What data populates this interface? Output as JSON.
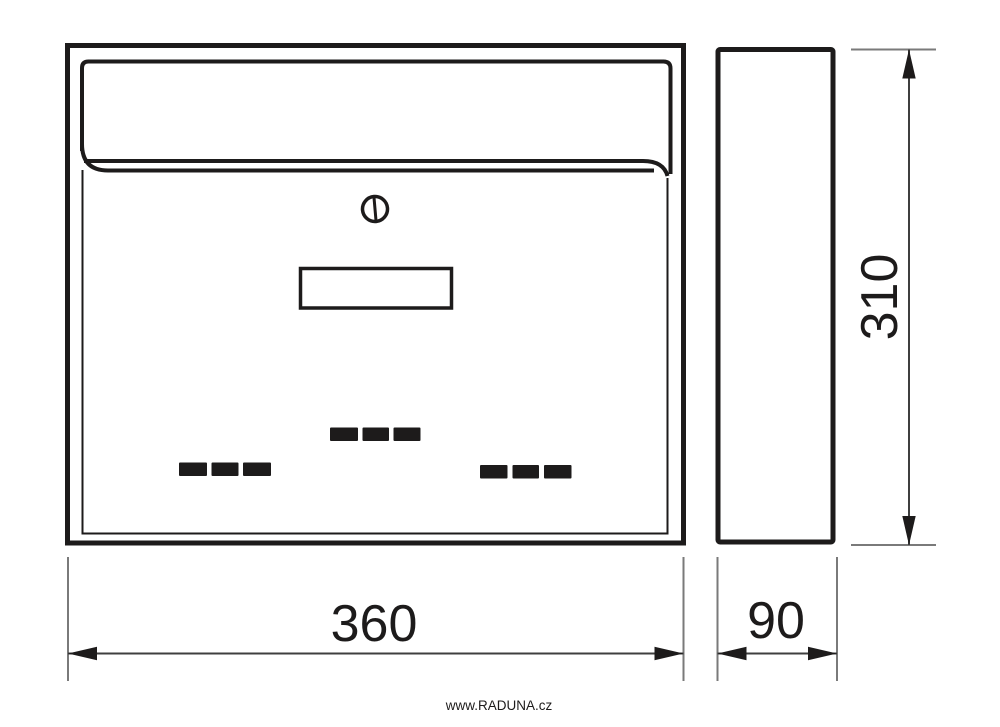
{
  "diagram": {
    "subject": "mailbox-dimension-drawing",
    "views": {
      "front": "front-view",
      "side": "side-view"
    },
    "dimensions": {
      "width": "360",
      "depth": "90",
      "height": "310"
    },
    "footer": {
      "website": "www.RADUNA.cz"
    },
    "icons": {
      "lock": "cylinder-lock-icon",
      "nameplate": "nameplate-window",
      "dashes": "redacted-text-dashes"
    },
    "colors": {
      "line": "#1d1b1b",
      "extension_line": "#7a7a7a",
      "dimension_line": "#3f3f3f",
      "background": "#ffffff"
    }
  }
}
